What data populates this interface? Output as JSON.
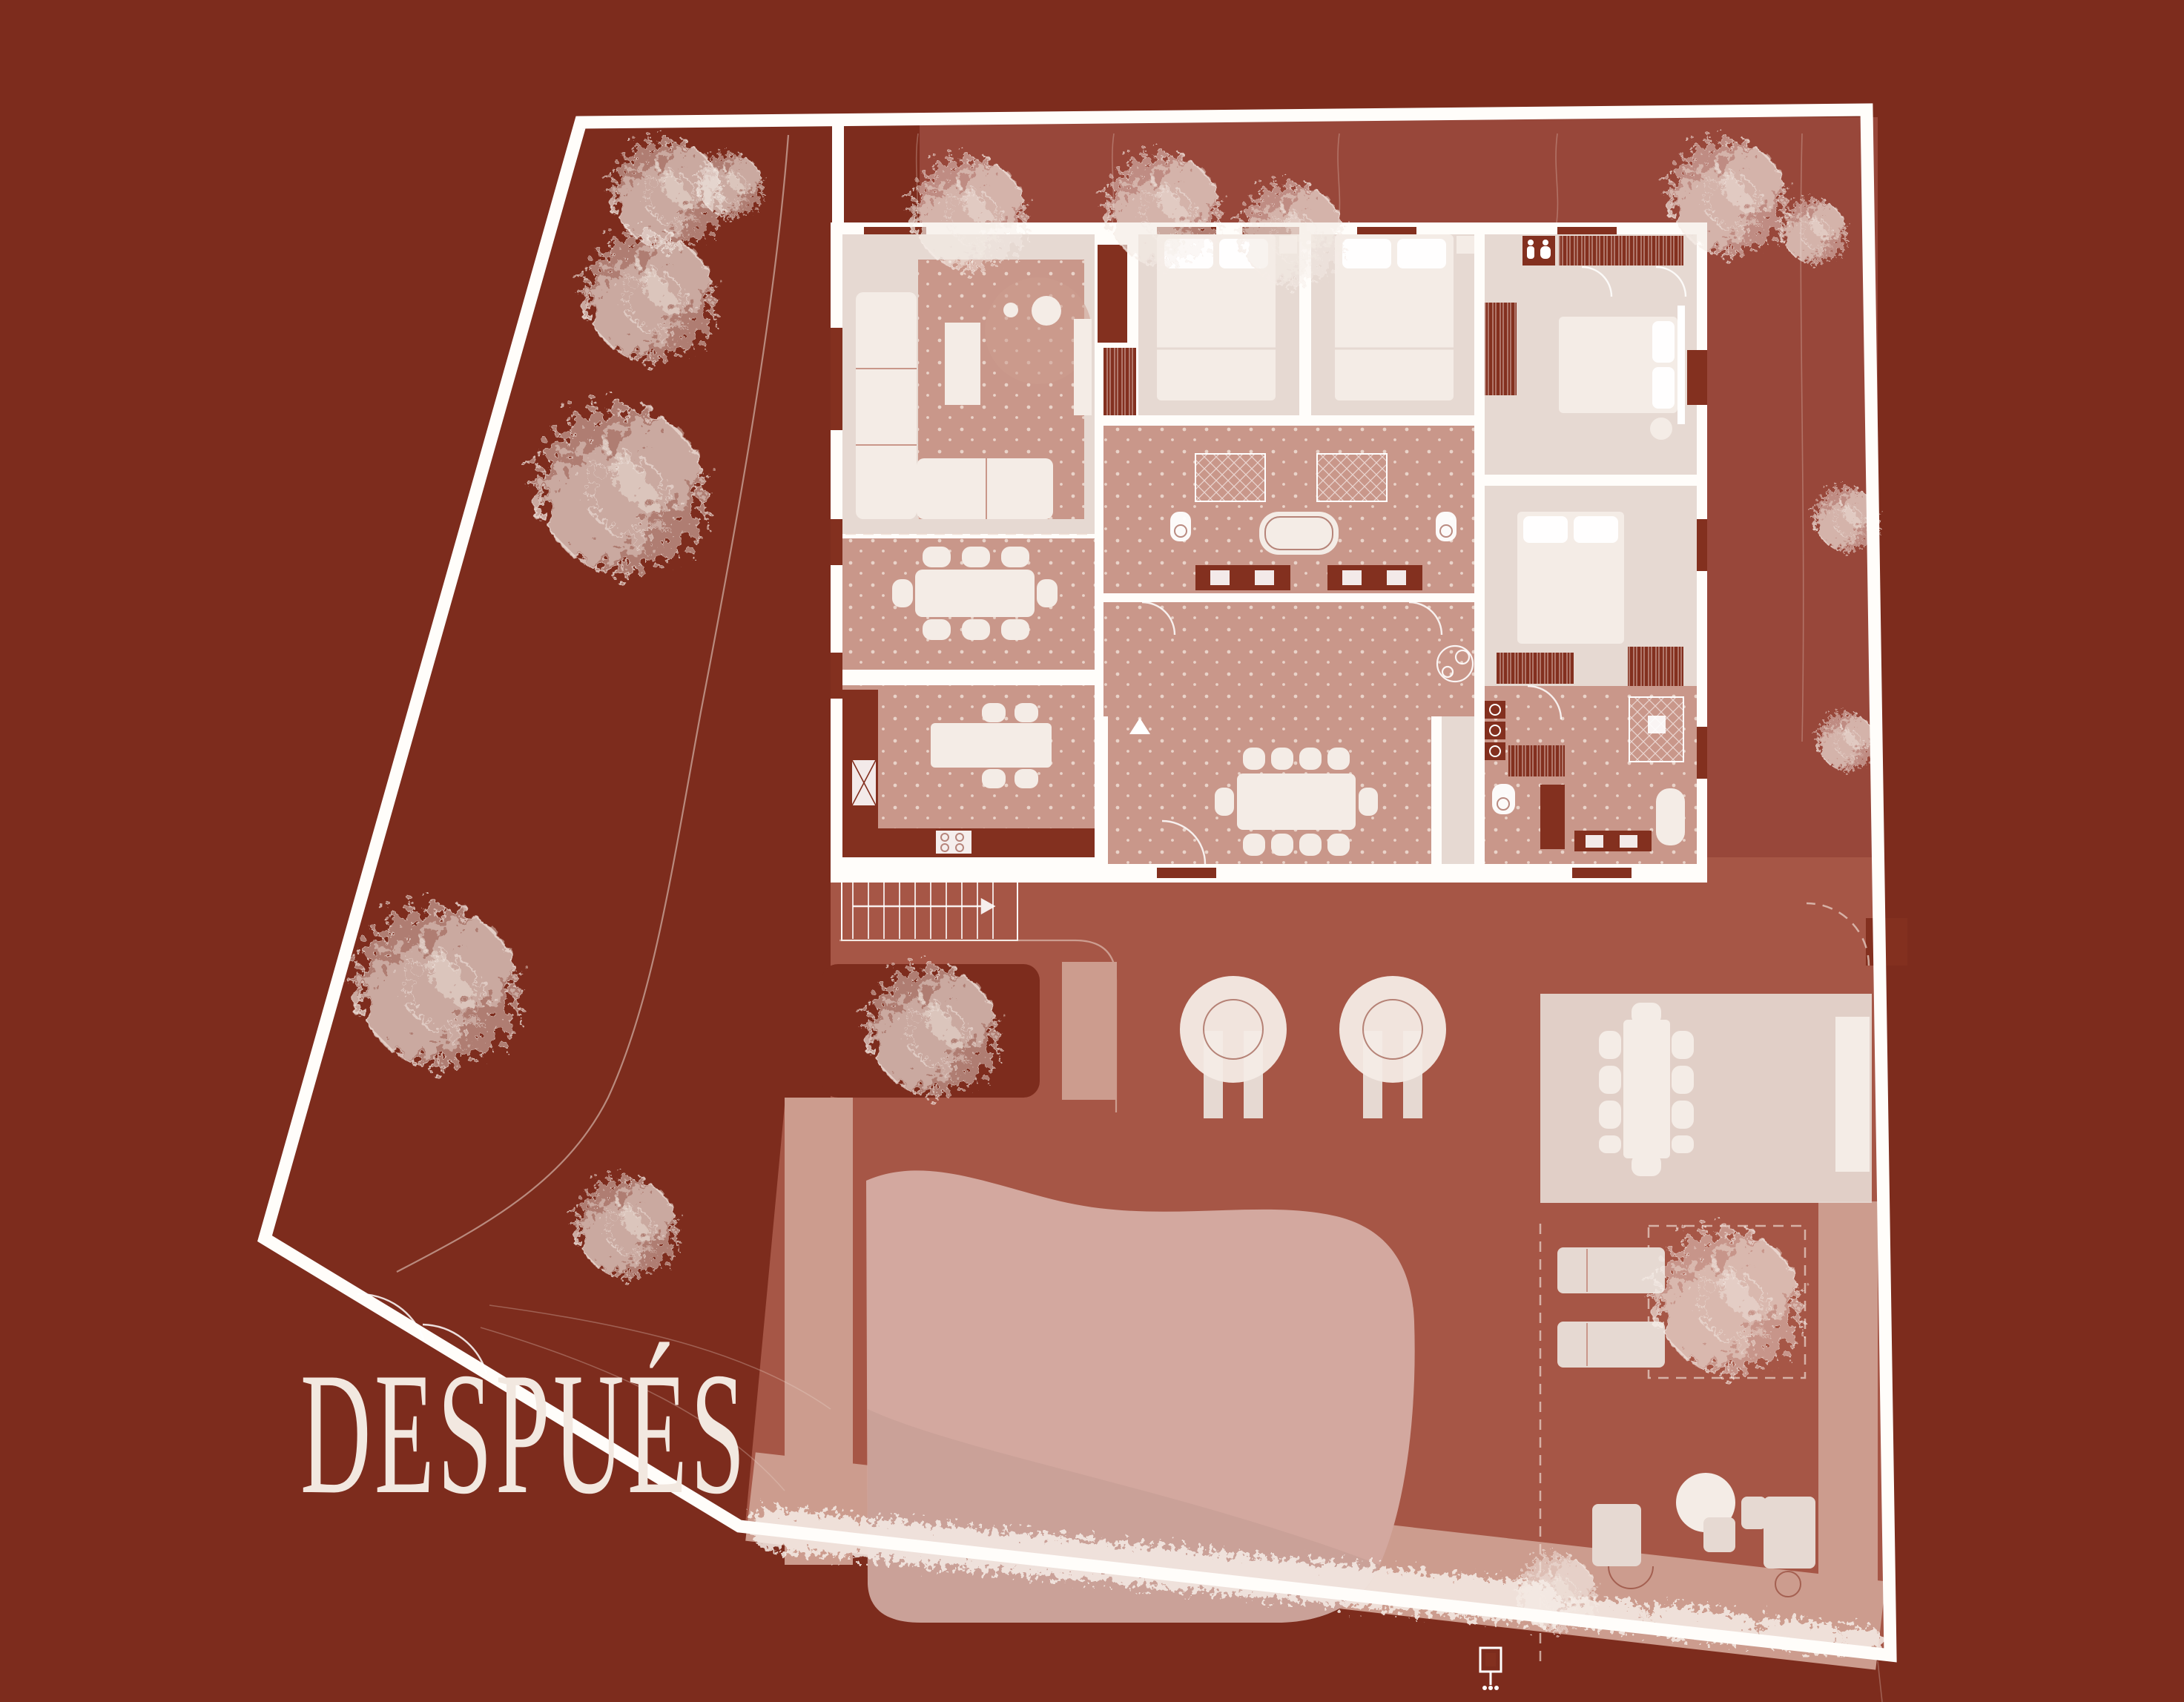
{
  "title": {
    "label": "DESPUÉS"
  },
  "palette": {
    "outside": "#7D2C1D",
    "strip": "#98473A",
    "deck": "#A65646",
    "rose": "#C9978A",
    "beige": "#E6D9D2",
    "cream": "#F4ECE6",
    "wall": "#FFFDFA",
    "accent": "#83301F",
    "pool": "#D3A89F",
    "band": "#CC9C8E",
    "sketch": "#F6EDE7",
    "dot": "#EFDDD4",
    "text": "#F2E8E0",
    "line": "#EBD8CE"
  }
}
